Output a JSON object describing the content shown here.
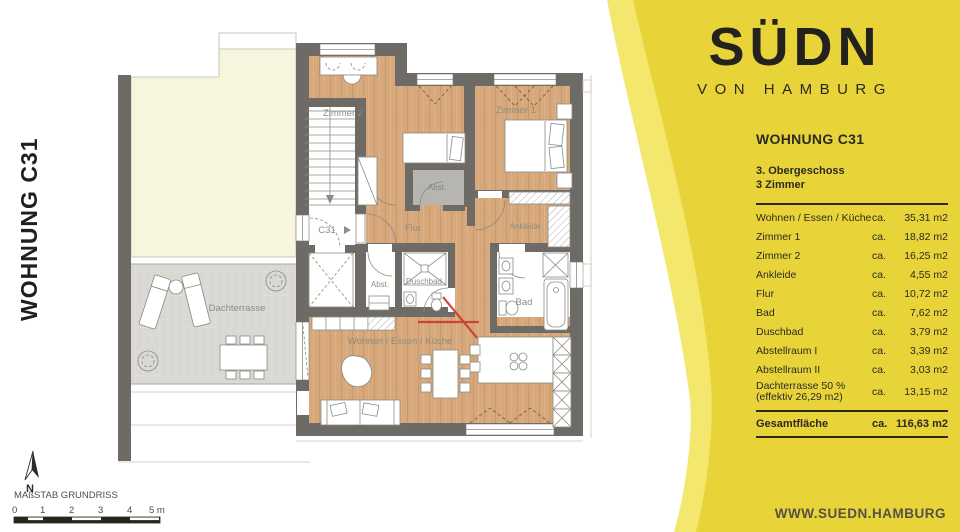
{
  "title_vertical": "WOHNUNG C31",
  "logo": {
    "brand": "SÜDN",
    "subtitle": "VON HAMBURG"
  },
  "panel": {
    "heading": "WOHNUNG C31",
    "floor_line1": "3. Obergeschoss",
    "floor_line2": "3 Zimmer",
    "rows": [
      {
        "label": "Wohnen / Essen / Küche",
        "ca": "ca.",
        "value": "35,31 m2"
      },
      {
        "label": "Zimmer 1",
        "ca": "ca.",
        "value": "18,82 m2"
      },
      {
        "label": "Zimmer 2",
        "ca": "ca.",
        "value": "16,25 m2"
      },
      {
        "label": "Ankleide",
        "ca": "ca.",
        "value": "4,55 m2"
      },
      {
        "label": "Flur",
        "ca": "ca.",
        "value": "10,72 m2"
      },
      {
        "label": "Bad",
        "ca": "ca.",
        "value": "7,62 m2"
      },
      {
        "label": "Duschbad",
        "ca": "ca.",
        "value": "3,79 m2"
      },
      {
        "label": "Abstellraum I",
        "ca": "ca.",
        "value": "3,39 m2"
      },
      {
        "label": "Abstellraum II",
        "ca": "ca.",
        "value": "3,03 m2"
      },
      {
        "label": "Dachterrasse 50 %",
        "label_sub": "(effektiv 26,29 m2)",
        "ca": "ca.",
        "value": "13,15 m2"
      }
    ],
    "total": {
      "label": "Gesamtfläche",
      "ca": "ca.",
      "value": "116,63 m2"
    },
    "website": "WWW.SUEDN.HAMBURG"
  },
  "plan": {
    "rooms": {
      "zimmer2": "Zimmer 2",
      "zimmer1": "Zimmer 1",
      "abst_top": "Abst.",
      "flur": "Flur",
      "ankleide": "Ankleide",
      "unit_door": "C31",
      "abst_mid": "Abst.",
      "duschbad": "Duschbad",
      "bad": "Bad",
      "wohnen": "Wohnen / Essen / Küche",
      "dachterrasse": "Dachterrasse"
    },
    "north_label": "N",
    "scale": {
      "title": "MAßSTAB GRUNDRISS",
      "ticks": [
        "0",
        "1",
        "2",
        "3",
        "4",
        "5 m"
      ]
    }
  },
  "colors": {
    "brand_yellow": "#e8d439",
    "light_yellow": "#f4e76d",
    "wall_gray": "#6e6b66",
    "wood": "#d6a87c",
    "terrace_gray": "#d9d8d3",
    "marker_red": "#cc392c"
  }
}
